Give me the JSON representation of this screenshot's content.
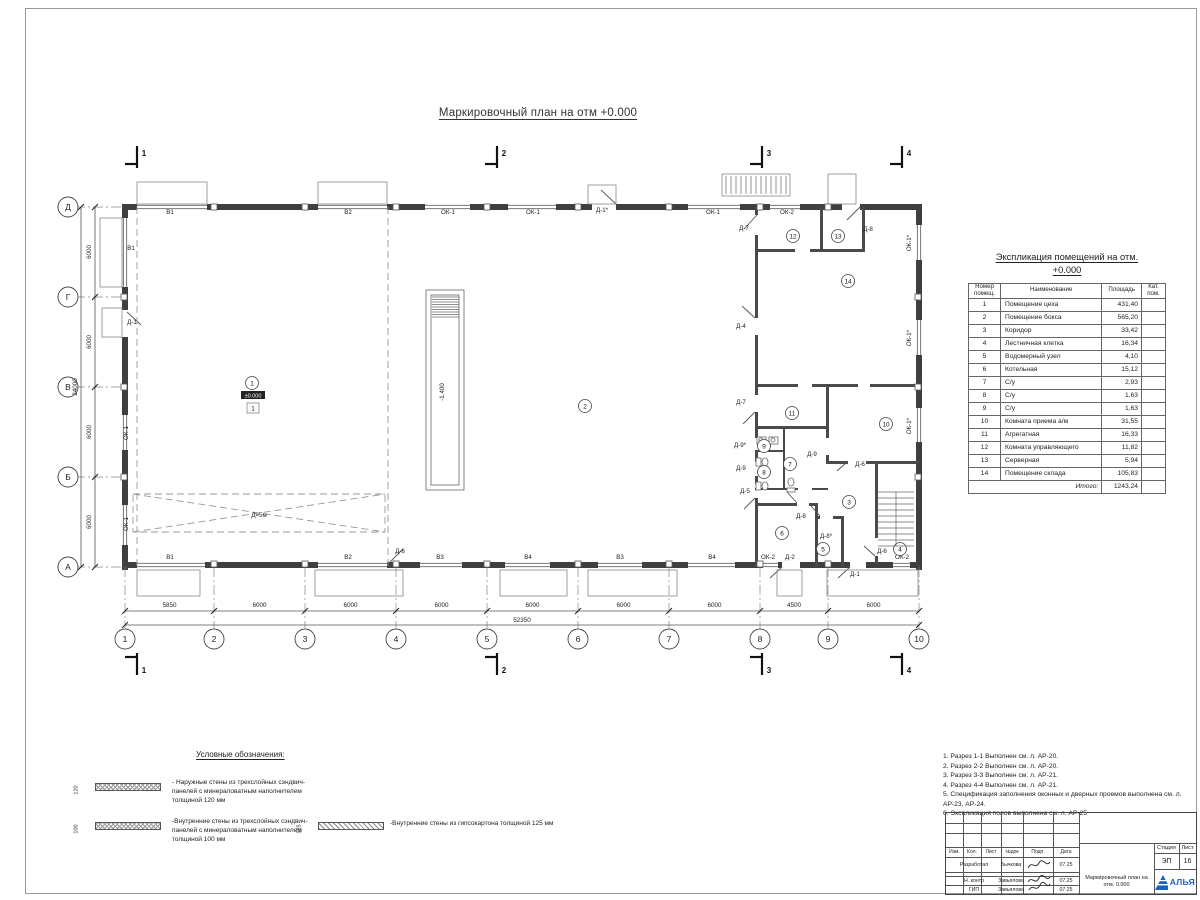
{
  "sheet": {
    "title": "Маркировочный план на отм +0.000"
  },
  "room_table": {
    "title_line1": "Экспликация помещений на отм.",
    "title_line2": "+0.000",
    "headers": {
      "num": "Номер помещ.",
      "name": "Наименование",
      "area": "Площадь",
      "cat": "Кат. пом."
    },
    "rows": [
      {
        "num": "1",
        "name": "Помещение цеха",
        "area": "431,40"
      },
      {
        "num": "2",
        "name": "Помещение бокса",
        "area": "565,20"
      },
      {
        "num": "3",
        "name": "Коридор",
        "area": "33,42"
      },
      {
        "num": "4",
        "name": "Лестничная клетка",
        "area": "16,34"
      },
      {
        "num": "5",
        "name": "Водомерный узел",
        "area": "4,10"
      },
      {
        "num": "6",
        "name": "Котельная",
        "area": "15,12"
      },
      {
        "num": "7",
        "name": "С/у",
        "area": "2,93"
      },
      {
        "num": "8",
        "name": "С/у",
        "area": "1,63"
      },
      {
        "num": "9",
        "name": "С/у",
        "area": "1,63"
      },
      {
        "num": "10",
        "name": "Комната приема а/м",
        "area": "31,55"
      },
      {
        "num": "11",
        "name": "Агрегатная",
        "area": "16,33"
      },
      {
        "num": "12",
        "name": "Комната управляющего",
        "area": "11,82"
      },
      {
        "num": "13",
        "name": "Серверная",
        "area": "5,94"
      },
      {
        "num": "14",
        "name": "Помещение склада",
        "area": "105,83"
      }
    ],
    "total_label": "Итого:",
    "total_value": "1243,24"
  },
  "legend": {
    "title": "Условные обозначения:",
    "items": [
      {
        "dim": "120",
        "hatch": "cross",
        "text": "- Наружные стены из трехслойных сэндвич-панелей с минераловатным наполнителем толщиной 120 мм"
      },
      {
        "dim": "100",
        "hatch": "cross",
        "text": "-Внутренние стены из трехслойных сэндвич-панелей с минераловатным наполнителем толщиной 100 мм"
      },
      {
        "dim": "125",
        "hatch": "diag",
        "text": "-Внутренние стены из гипсокартона толщиной 125 мм"
      }
    ]
  },
  "notes": [
    "1. Разрез 1-1 Выполнен см. л. АР-20.",
    "2. Разрез 2-2 Выполнен см. л. АР-20.",
    "3. Разрез 3-3 Выполнен см. л. АР-21.",
    "4. Разрез 4-4 Выполнен см. л. АР-21.",
    "5. Спецификация заполнения оконных и дверных проемов выполнена см. л. АР-23, АР-24.",
    "6. Экспликация полов выполнена см. л. АР-25"
  ],
  "title_block": {
    "header_cells": [
      "Изм.",
      "Кол.",
      "Лист",
      "№док",
      "Подп.",
      "Дата"
    ],
    "rows": [
      {
        "role": "Разработал",
        "name": "Бычкова",
        "date": "07.25"
      },
      {
        "role": "",
        "name": "",
        "date": ""
      },
      {
        "role": "Н. контр",
        "name": "Завьялова",
        "date": "07.25"
      },
      {
        "role": "ГИП",
        "name": "Завьялова",
        "date": "07.25"
      }
    ],
    "doc_title": "Маркировочный план на отм. 0.000",
    "stage_label": "Стадия",
    "stage_value": "ЭП",
    "sheet_label": "Лист",
    "sheet_value": "16",
    "logo_text": "АЛЬЯ"
  },
  "plan": {
    "row_axes": [
      {
        "label": "Д",
        "y": 207
      },
      {
        "label": "Г",
        "y": 297
      },
      {
        "label": "В",
        "y": 387
      },
      {
        "label": "Б",
        "y": 477
      },
      {
        "label": "А",
        "y": 567
      }
    ],
    "col_axes": [
      {
        "label": "1",
        "x": 125
      },
      {
        "label": "2",
        "x": 214
      },
      {
        "label": "3",
        "x": 305
      },
      {
        "label": "4",
        "x": 396
      },
      {
        "label": "5",
        "x": 487
      },
      {
        "label": "6",
        "x": 578
      },
      {
        "label": "7",
        "x": 669
      },
      {
        "label": "8",
        "x": 760
      },
      {
        "label": "9",
        "x": 828
      },
      {
        "label": "10",
        "x": 919
      }
    ],
    "dims_bottom": [
      "5850",
      "6000",
      "6000",
      "6000",
      "6000",
      "6000",
      "6000",
      "4500",
      "6000"
    ],
    "total_bottom": "52350",
    "dims_left": [
      "6000",
      "6000",
      "6000",
      "6000"
    ],
    "total_left": "24000",
    "section_marks": [
      {
        "label": "1",
        "x": 137,
        "top": true
      },
      {
        "label": "2",
        "x": 497,
        "top": true
      },
      {
        "label": "3",
        "x": 762,
        "top": true
      },
      {
        "label": "4",
        "x": 902,
        "top": true
      },
      {
        "label": "1",
        "x": 137,
        "top": false
      },
      {
        "label": "2",
        "x": 497,
        "top": false
      },
      {
        "label": "3",
        "x": 762,
        "top": false
      },
      {
        "label": "4",
        "x": 902,
        "top": false
      }
    ],
    "room_marks": [
      {
        "n": "1",
        "x": 252,
        "y": 383
      },
      {
        "n": "2",
        "x": 585,
        "y": 406
      },
      {
        "n": "3",
        "x": 849,
        "y": 502
      },
      {
        "n": "4",
        "x": 900,
        "y": 549
      },
      {
        "n": "5",
        "x": 823,
        "y": 549
      },
      {
        "n": "6",
        "x": 782,
        "y": 533
      },
      {
        "n": "7",
        "x": 790,
        "y": 464
      },
      {
        "n": "8",
        "x": 764,
        "y": 472
      },
      {
        "n": "9",
        "x": 764,
        "y": 446
      },
      {
        "n": "10",
        "x": 886,
        "y": 424
      },
      {
        "n": "11",
        "x": 792,
        "y": 413
      },
      {
        "n": "12",
        "x": 793,
        "y": 236
      },
      {
        "n": "13",
        "x": 838,
        "y": 236
      },
      {
        "n": "14",
        "x": 848,
        "y": 281
      }
    ],
    "labels": [
      {
        "t": "В1",
        "x": 170,
        "y": 214
      },
      {
        "t": "В2",
        "x": 348,
        "y": 214
      },
      {
        "t": "ОК-1",
        "x": 448,
        "y": 214
      },
      {
        "t": "ОК-1",
        "x": 533,
        "y": 214
      },
      {
        "t": "Д-1*",
        "x": 602,
        "y": 212
      },
      {
        "t": "ОК-1",
        "x": 713,
        "y": 214
      },
      {
        "t": "ОК-2",
        "x": 787,
        "y": 214
      },
      {
        "t": "Д-7",
        "x": 744,
        "y": 230
      },
      {
        "t": "Д-8",
        "x": 868,
        "y": 231
      },
      {
        "t": "ОК-1*",
        "x": 911,
        "y": 243,
        "r": 1
      },
      {
        "t": "ОК-1*",
        "x": 911,
        "y": 338,
        "r": 1
      },
      {
        "t": "ОК-1*",
        "x": 911,
        "y": 426,
        "r": 1
      },
      {
        "t": "В1",
        "x": 131,
        "y": 250
      },
      {
        "t": "Д-1",
        "x": 132,
        "y": 324
      },
      {
        "t": "ОК-1",
        "x": 128,
        "y": 433,
        "r": 1
      },
      {
        "t": "ОК-1",
        "x": 128,
        "y": 524,
        "r": 1
      },
      {
        "t": "В1",
        "x": 170,
        "y": 559
      },
      {
        "t": "В2",
        "x": 348,
        "y": 559
      },
      {
        "t": "В3",
        "x": 440,
        "y": 559
      },
      {
        "t": "В4",
        "x": 528,
        "y": 559
      },
      {
        "t": "В3",
        "x": 620,
        "y": 559
      },
      {
        "t": "В4",
        "x": 712,
        "y": 559
      },
      {
        "t": "ОК-2",
        "x": 768,
        "y": 559
      },
      {
        "t": "Д-2",
        "x": 790,
        "y": 559
      },
      {
        "t": "Д-1",
        "x": 855,
        "y": 576
      },
      {
        "t": "Д-6",
        "x": 882,
        "y": 553
      },
      {
        "t": "ОК-2",
        "x": 902,
        "y": 559
      },
      {
        "t": "Д-6",
        "x": 400,
        "y": 553
      },
      {
        "t": "Д-4",
        "x": 741,
        "y": 328
      },
      {
        "t": "Д-7",
        "x": 741,
        "y": 404
      },
      {
        "t": "Д-9*",
        "x": 740,
        "y": 447
      },
      {
        "t": "Д-9",
        "x": 741,
        "y": 470
      },
      {
        "t": "Д-5",
        "x": 745,
        "y": 493
      },
      {
        "t": "Д-9",
        "x": 812,
        "y": 456
      },
      {
        "t": "Д-8",
        "x": 801,
        "y": 518
      },
      {
        "t": "Д-8*",
        "x": 826,
        "y": 538
      },
      {
        "t": "Д-6",
        "x": 860,
        "y": 466
      }
    ],
    "level_mark": "±0.000",
    "floor_mark": "1",
    "pit_label": "-1.400",
    "crane_label": "Д=5м"
  }
}
